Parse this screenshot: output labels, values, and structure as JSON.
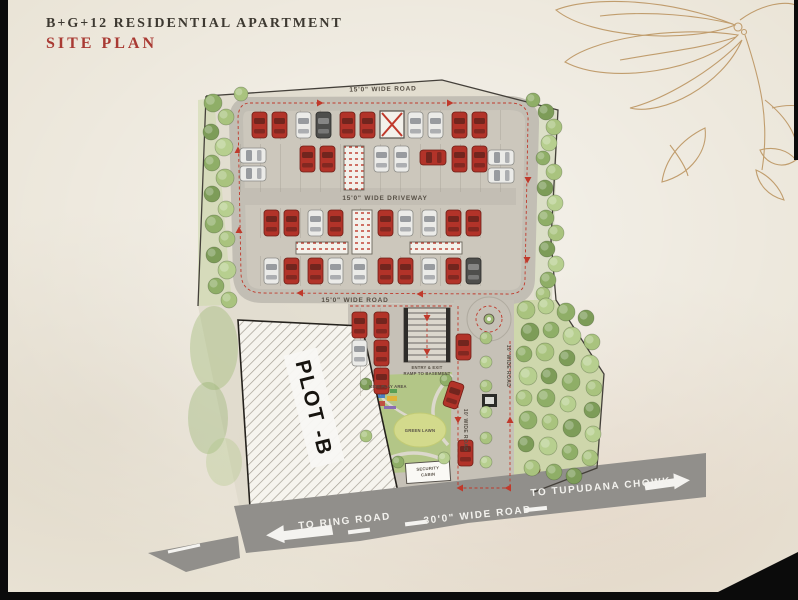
{
  "header": {
    "title": "B+G+12 RESIDENTIAL APARTMENT",
    "subtitle": "SITE PLAN"
  },
  "plan": {
    "road_labels": {
      "top": "15'0\" WIDE ROAD",
      "driveway": "15'0\" WIDE DRIVEWAY",
      "lower": "15'0\" WIDE ROAD",
      "side": "10' WIDE ROAD",
      "side2": "10' WIDE ROAD"
    },
    "area_labels": {
      "plot": "PLOT -B",
      "ramp_line1": "ENTRY & EXIT",
      "ramp_line2": "RAMP TO BASEMENT",
      "cabin_line1": "SECURITY",
      "cabin_line2": "CABIN",
      "kids": "KIDS PLAY AREA",
      "lawn": "GREEN LAWN"
    },
    "bottom_road": {
      "left": "TO RING ROAD",
      "center": "30'0\" WIDE ROAD",
      "right": "TO TUPUDANA CHOWK"
    },
    "colors": {
      "paper": "#e9e3d5",
      "road": "#c2beb4",
      "parking": "#ccc7bc",
      "bottom_road": "#918f8b",
      "dash_red": "#c0392b",
      "boundary": "#44403a",
      "flower_ink": "#b9905a",
      "tree_palette": [
        "#8fae67",
        "#a9c37e",
        "#7d9c58",
        "#b7cf8f"
      ],
      "cars": {
        "r": {
          "body": "#b23329",
          "stroke": "#6f1f17",
          "glass": "rgba(35,20,18,0.45)"
        },
        "w": {
          "body": "#ebebe8",
          "stroke": "#8b8b86",
          "glass": "rgba(70,75,85,0.5)"
        },
        "d": {
          "body": "#4e4e4c",
          "stroke": "#2c2c2a",
          "glass": "rgba(240,240,240,0.35)"
        }
      }
    },
    "stall_strips": [
      [
        248,
        110,
        266,
        30
      ],
      [
        238,
        144,
        278,
        48
      ],
      [
        260,
        208,
        232,
        30
      ],
      [
        260,
        256,
        232,
        30
      ],
      [
        348,
        308,
        52,
        88
      ]
    ],
    "cores": [
      [
        344,
        146,
        20,
        44
      ],
      [
        352,
        210,
        20,
        44
      ],
      [
        296,
        242,
        52,
        12
      ],
      [
        410,
        242,
        52,
        12
      ]
    ],
    "cars": [
      [
        252,
        112,
        "v",
        "r"
      ],
      [
        272,
        112,
        "v",
        "r"
      ],
      [
        296,
        112,
        "v",
        "w"
      ],
      [
        316,
        112,
        "v",
        "d"
      ],
      [
        340,
        112,
        "v",
        "r"
      ],
      [
        360,
        112,
        "v",
        "r"
      ],
      [
        408,
        112,
        "v",
        "w"
      ],
      [
        428,
        112,
        "v",
        "w"
      ],
      [
        452,
        112,
        "v",
        "r"
      ],
      [
        472,
        112,
        "v",
        "r"
      ],
      [
        240,
        148,
        "h",
        "w"
      ],
      [
        240,
        166,
        "h",
        "w"
      ],
      [
        300,
        146,
        "v",
        "r"
      ],
      [
        320,
        146,
        "v",
        "r"
      ],
      [
        374,
        146,
        "v",
        "w"
      ],
      [
        394,
        146,
        "v",
        "w"
      ],
      [
        420,
        150,
        "h",
        "r"
      ],
      [
        452,
        146,
        "v",
        "r"
      ],
      [
        472,
        146,
        "v",
        "r"
      ],
      [
        488,
        150,
        "h",
        "w"
      ],
      [
        488,
        168,
        "h",
        "w"
      ],
      [
        264,
        210,
        "v",
        "r"
      ],
      [
        284,
        210,
        "v",
        "r"
      ],
      [
        308,
        210,
        "v",
        "w"
      ],
      [
        328,
        210,
        "v",
        "r"
      ],
      [
        378,
        210,
        "v",
        "r"
      ],
      [
        398,
        210,
        "v",
        "w"
      ],
      [
        422,
        210,
        "v",
        "w"
      ],
      [
        446,
        210,
        "v",
        "r"
      ],
      [
        466,
        210,
        "v",
        "r"
      ],
      [
        264,
        258,
        "v",
        "w"
      ],
      [
        284,
        258,
        "v",
        "r"
      ],
      [
        308,
        258,
        "v",
        "r"
      ],
      [
        328,
        258,
        "v",
        "w"
      ],
      [
        352,
        258,
        "v",
        "w"
      ],
      [
        378,
        258,
        "v",
        "r"
      ],
      [
        398,
        258,
        "v",
        "r"
      ],
      [
        422,
        258,
        "v",
        "w"
      ],
      [
        446,
        258,
        "v",
        "r"
      ],
      [
        466,
        258,
        "v",
        "d"
      ],
      [
        352,
        312,
        "v",
        "r"
      ],
      [
        374,
        312,
        "v",
        "r"
      ],
      [
        352,
        340,
        "v",
        "w"
      ],
      [
        374,
        340,
        "v",
        "r"
      ],
      [
        374,
        368,
        "v",
        "r"
      ],
      [
        456,
        334,
        "v",
        "r"
      ],
      [
        446,
        382,
        "v",
        "r",
        18
      ],
      [
        458,
        440,
        "v",
        "r"
      ]
    ],
    "trees": [
      [
        213,
        103,
        9,
        0
      ],
      [
        226,
        117,
        8,
        1
      ],
      [
        211,
        132,
        8,
        2
      ],
      [
        224,
        147,
        9,
        3
      ],
      [
        212,
        163,
        8,
        0
      ],
      [
        225,
        178,
        9,
        1
      ],
      [
        212,
        194,
        8,
        2
      ],
      [
        226,
        209,
        8,
        3
      ],
      [
        214,
        224,
        9,
        0
      ],
      [
        227,
        239,
        8,
        1
      ],
      [
        214,
        255,
        8,
        2
      ],
      [
        227,
        270,
        9,
        3
      ],
      [
        216,
        286,
        8,
        0
      ],
      [
        229,
        300,
        8,
        1
      ],
      [
        241,
        94,
        7,
        1
      ],
      [
        533,
        100,
        7,
        0
      ],
      [
        546,
        112,
        8,
        2
      ],
      [
        554,
        127,
        8,
        1
      ],
      [
        549,
        143,
        8,
        3
      ],
      [
        543,
        158,
        7,
        0
      ],
      [
        554,
        172,
        8,
        1
      ],
      [
        545,
        188,
        8,
        2
      ],
      [
        555,
        203,
        8,
        3
      ],
      [
        546,
        218,
        8,
        0
      ],
      [
        556,
        233,
        8,
        1
      ],
      [
        547,
        249,
        8,
        2
      ],
      [
        556,
        264,
        8,
        3
      ],
      [
        548,
        280,
        8,
        0
      ],
      [
        543,
        294,
        7,
        1
      ],
      [
        526,
        310,
        9,
        1
      ],
      [
        546,
        306,
        8,
        3
      ],
      [
        566,
        312,
        9,
        0
      ],
      [
        586,
        318,
        8,
        2
      ],
      [
        530,
        332,
        9,
        2
      ],
      [
        551,
        330,
        8,
        0
      ],
      [
        572,
        336,
        9,
        3
      ],
      [
        592,
        342,
        8,
        1
      ],
      [
        524,
        354,
        8,
        0
      ],
      [
        545,
        352,
        9,
        1
      ],
      [
        567,
        358,
        8,
        2
      ],
      [
        590,
        364,
        9,
        3
      ],
      [
        528,
        376,
        9,
        3
      ],
      [
        549,
        376,
        8,
        2
      ],
      [
        571,
        382,
        9,
        0
      ],
      [
        594,
        388,
        8,
        1
      ],
      [
        524,
        398,
        8,
        1
      ],
      [
        546,
        398,
        9,
        0
      ],
      [
        568,
        404,
        8,
        3
      ],
      [
        592,
        410,
        8,
        2
      ],
      [
        528,
        420,
        9,
        0
      ],
      [
        550,
        422,
        8,
        1
      ],
      [
        572,
        428,
        9,
        2
      ],
      [
        593,
        434,
        8,
        3
      ],
      [
        526,
        444,
        8,
        2
      ],
      [
        548,
        446,
        9,
        3
      ],
      [
        570,
        452,
        8,
        0
      ],
      [
        590,
        458,
        8,
        1
      ],
      [
        532,
        468,
        8,
        1
      ],
      [
        554,
        472,
        8,
        0
      ],
      [
        574,
        476,
        8,
        2
      ],
      [
        486,
        338,
        6,
        1
      ],
      [
        486,
        362,
        6,
        3
      ],
      [
        486,
        386,
        6,
        1
      ],
      [
        486,
        412,
        6,
        3
      ],
      [
        486,
        438,
        6,
        1
      ],
      [
        486,
        462,
        6,
        3
      ],
      [
        366,
        384,
        6,
        2
      ],
      [
        446,
        380,
        6,
        0
      ],
      [
        366,
        436,
        6,
        1
      ],
      [
        444,
        458,
        6,
        3
      ],
      [
        398,
        462,
        6,
        0
      ]
    ],
    "red_markers": [
      [
        320,
        103,
        90
      ],
      [
        450,
        103,
        90
      ],
      [
        528,
        180,
        180
      ],
      [
        527,
        260,
        180
      ],
      [
        420,
        294,
        270
      ],
      [
        300,
        293,
        270
      ],
      [
        239,
        230,
        0
      ],
      [
        238,
        150,
        0
      ],
      [
        427,
        318,
        180
      ],
      [
        427,
        352,
        180
      ],
      [
        458,
        420,
        180
      ],
      [
        510,
        420,
        0
      ],
      [
        460,
        488,
        270
      ],
      [
        508,
        488,
        270
      ]
    ]
  }
}
